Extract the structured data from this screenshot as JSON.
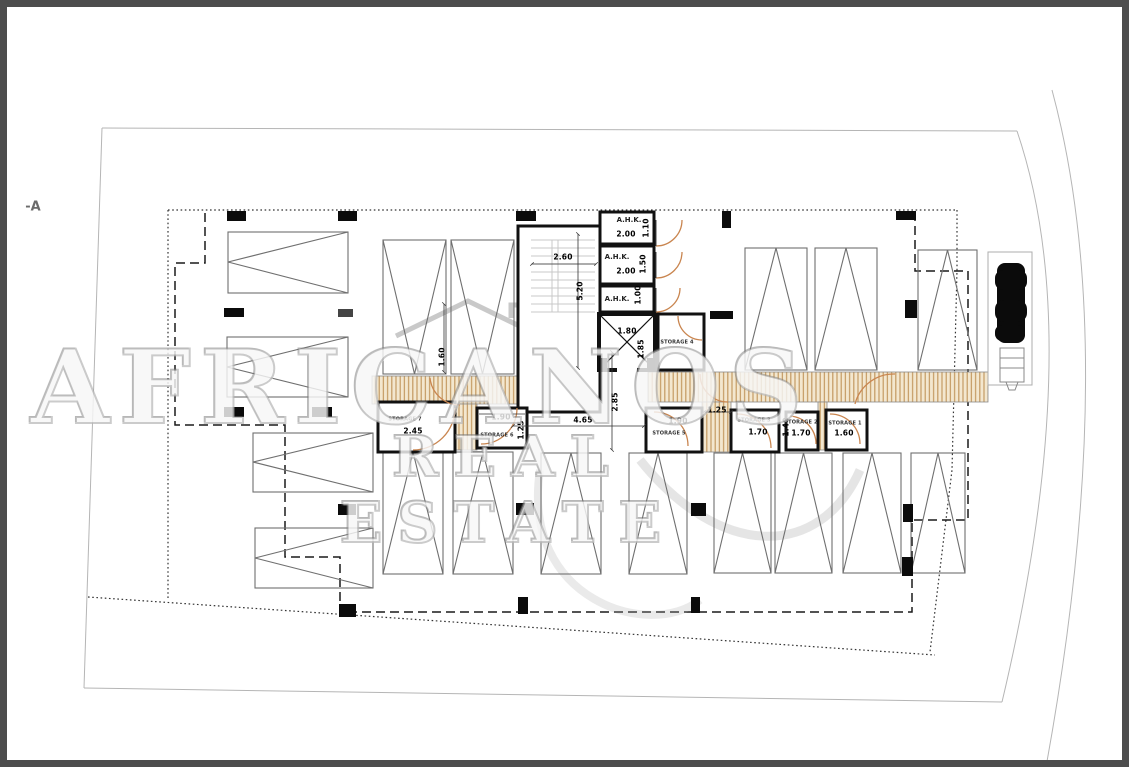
{
  "drawing": {
    "type": "basement parking floor plan",
    "section_marker": "-A"
  },
  "watermark": {
    "brand": "AFRICANOS",
    "tagline": "REAL ESTATE"
  },
  "labels": {
    "ahk": "A.H.K.",
    "storage1": "STORAGE 1",
    "storage2": "STORAGE 2",
    "storage3": "STORAGE 3",
    "storage4": "STORAGE 4",
    "storage5": "STORAGE 5",
    "storage6": "STORAGE 6",
    "storage7": "STORAGE 7"
  },
  "dims": {
    "stair_width": "2.60",
    "stair_height": "5.20",
    "ahk1_width": "2.00",
    "ahk1_depth": "1.10",
    "ahk2_width": "2.00",
    "ahk2_depth": "1.50",
    "ahk3_depth": "1.00",
    "lift_width": "1.80",
    "lift_depth": "1.85",
    "ramp_width": "1.60",
    "storage7_width": "2.45",
    "storage6_width": "1.90",
    "storage6_depth": "1.25",
    "corridor_width": "4.65",
    "corridor_depth": "2.85",
    "storage5_width": "1.90",
    "passage_width": "1.25",
    "storage3_width": "1.70",
    "storage3_depth": "1.40",
    "storage2_width": "1.70",
    "storage1_width": "1.60"
  },
  "colors": {
    "frame": "#4d4d4d",
    "walls": "#111111",
    "parking_lines": "#6f6f6f",
    "door_arc": "#c9854f",
    "ramp_hatch": "#c49a62",
    "boundary_light": "#b5b5b5"
  }
}
